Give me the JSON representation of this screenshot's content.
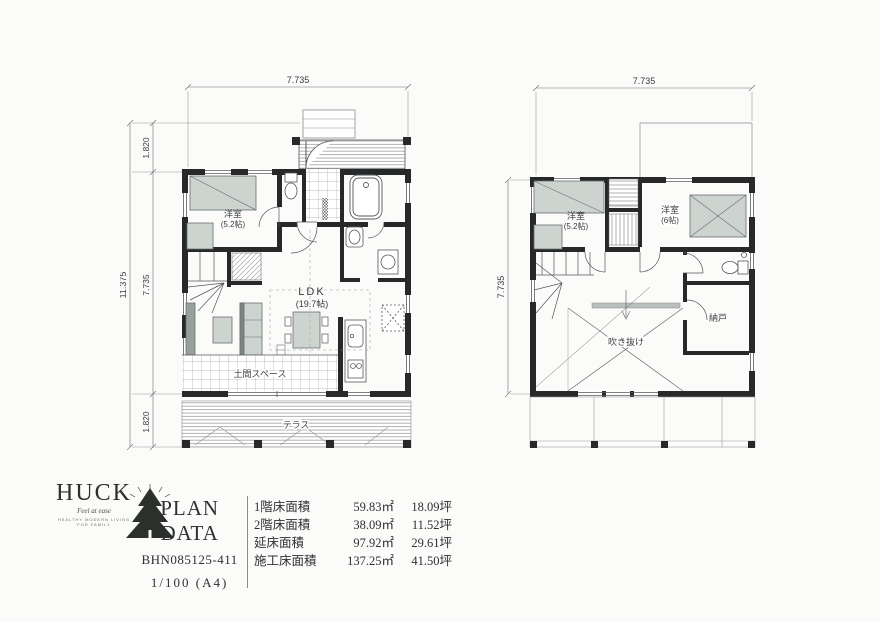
{
  "floor1": {
    "dim_top": "7.735",
    "dim_total": "11.375",
    "dim_seg_top": "1.820",
    "dim_seg_mid": "7.735",
    "dim_seg_bottom": "1.820",
    "labels": {
      "bedroom": "洋室",
      "bedroom_size": "(5.2帖)",
      "ldk": "LDK",
      "ldk_size": "(19.7帖)",
      "doma": "土間スペース",
      "terrace": "テラス"
    }
  },
  "floor2": {
    "dim_top": "7.735",
    "dim_left": "7.735",
    "labels": {
      "bedroom1": "洋室",
      "bedroom1_size": "(5.2帖)",
      "bedroom2": "洋室",
      "bedroom2_size": "(6帖)",
      "void": "吹き抜け",
      "storage": "納戸"
    }
  },
  "titleblock": {
    "brand": "HUCK",
    "tagline": "Feel at ease",
    "subtext": "HEALTHY MODERN LIVING FOR FAMILY",
    "title": "PLAN DATA",
    "plan_number": "BHN085125-411",
    "scale": "1/100 (A4)",
    "areas": [
      {
        "label": "1階床面積",
        "sqm": "59.83㎡",
        "tsubo": "18.09坪"
      },
      {
        "label": "2階床面積",
        "sqm": "38.09㎡",
        "tsubo": "11.52坪"
      },
      {
        "label": "延床面積",
        "sqm": "97.92㎡",
        "tsubo": "29.61坪"
      },
      {
        "label": "施工床面積",
        "sqm": "137.25㎡",
        "tsubo": "41.50坪"
      }
    ]
  },
  "colors": {
    "wall": "#26282a",
    "line": "#55585a",
    "furniture": "#cdd4d0",
    "paper": "#fbfbf9"
  }
}
